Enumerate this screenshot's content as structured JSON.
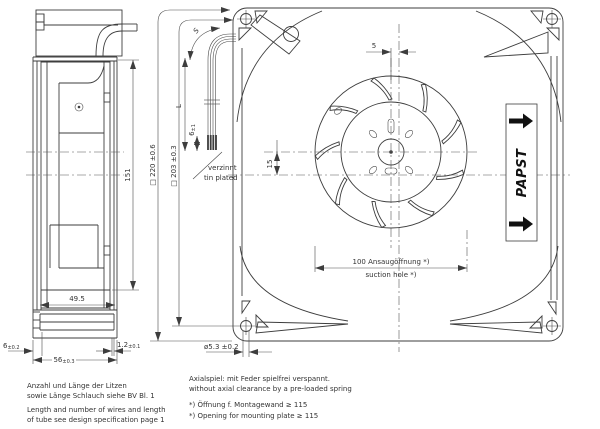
{
  "side": {
    "dim_151": "151",
    "dim_49_5": "49.5",
    "dim_6_val": "6",
    "dim_6_tol": "±0.2",
    "dim_1_2_val": "1.2",
    "dim_1_2_tol": "±0.1",
    "dim_56_val": "56",
    "dim_56_tol": "±0.3"
  },
  "front": {
    "dim_square_220": "□ 220 ±0.6",
    "dim_square_203": "□ 203 ±0.3",
    "dim_5": "5",
    "dim_15": "15",
    "dim_wire_length": "L",
    "dim_wire_bend": "S",
    "dim_tinned_val": "6",
    "dim_tinned_tol": "±1",
    "tinned_de": "verzinnt",
    "tinned_en": "tin plated",
    "suction_de": "100 Ansaugöffnung *)",
    "suction_en": "suction hole *)",
    "mount_hole": "ø5.3 ±0.2",
    "brand": "PAPST"
  },
  "notes": {
    "left_de_1": "Anzahl und Länge der Litzen",
    "left_de_2": "sowie Länge Schlauch siehe BV Bl. 1",
    "left_en_1": "Length and number of wires and length",
    "left_en_2": "of tube see design specification page 1",
    "center_de": "Axialspiel: mit Feder spielfrei verspannt.",
    "center_en": "without axial clearance by a pre-loaded spring",
    "star_de": "*) Öffnung f. Montagewand ≥ 115",
    "star_en": "*) Opening for mounting plate ≥ 115"
  },
  "colors": {
    "ink": "#3d3d3d",
    "text": "#333333",
    "brand": "#111111"
  }
}
